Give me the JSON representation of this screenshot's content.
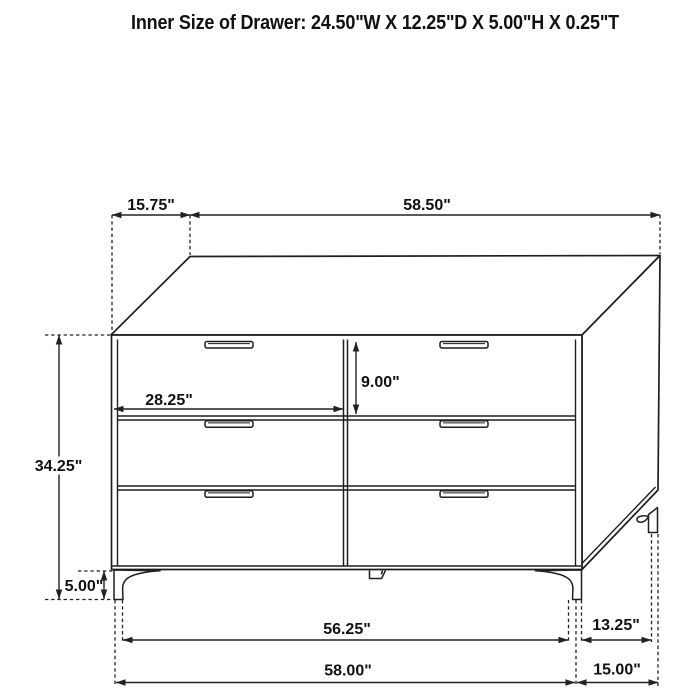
{
  "header": {
    "title": "Inner Size of Drawer: 24.50\"W X 12.25\"D X 5.00\"H X 0.25\"T"
  },
  "labels": {
    "top_depth": "15.75\"",
    "top_width": "58.50\"",
    "drawer_width": "28.25\"",
    "drawer_height": "9.00\"",
    "cabinet_height": "34.25\"",
    "leg_height": "5.00\"",
    "front_leg_span": "56.25\"",
    "side_leg_span": "13.25\"",
    "overall_width": "58.00\"",
    "overall_depth": "15.00\""
  },
  "drawing": {
    "type": "furniture-dimension-diagram",
    "object": "6-drawer dresser",
    "drawer_count": 6
  },
  "colors": {
    "background": "#ffffff",
    "line": "#1f1f1f",
    "dimension_line": "#222222",
    "text": "#111111"
  }
}
